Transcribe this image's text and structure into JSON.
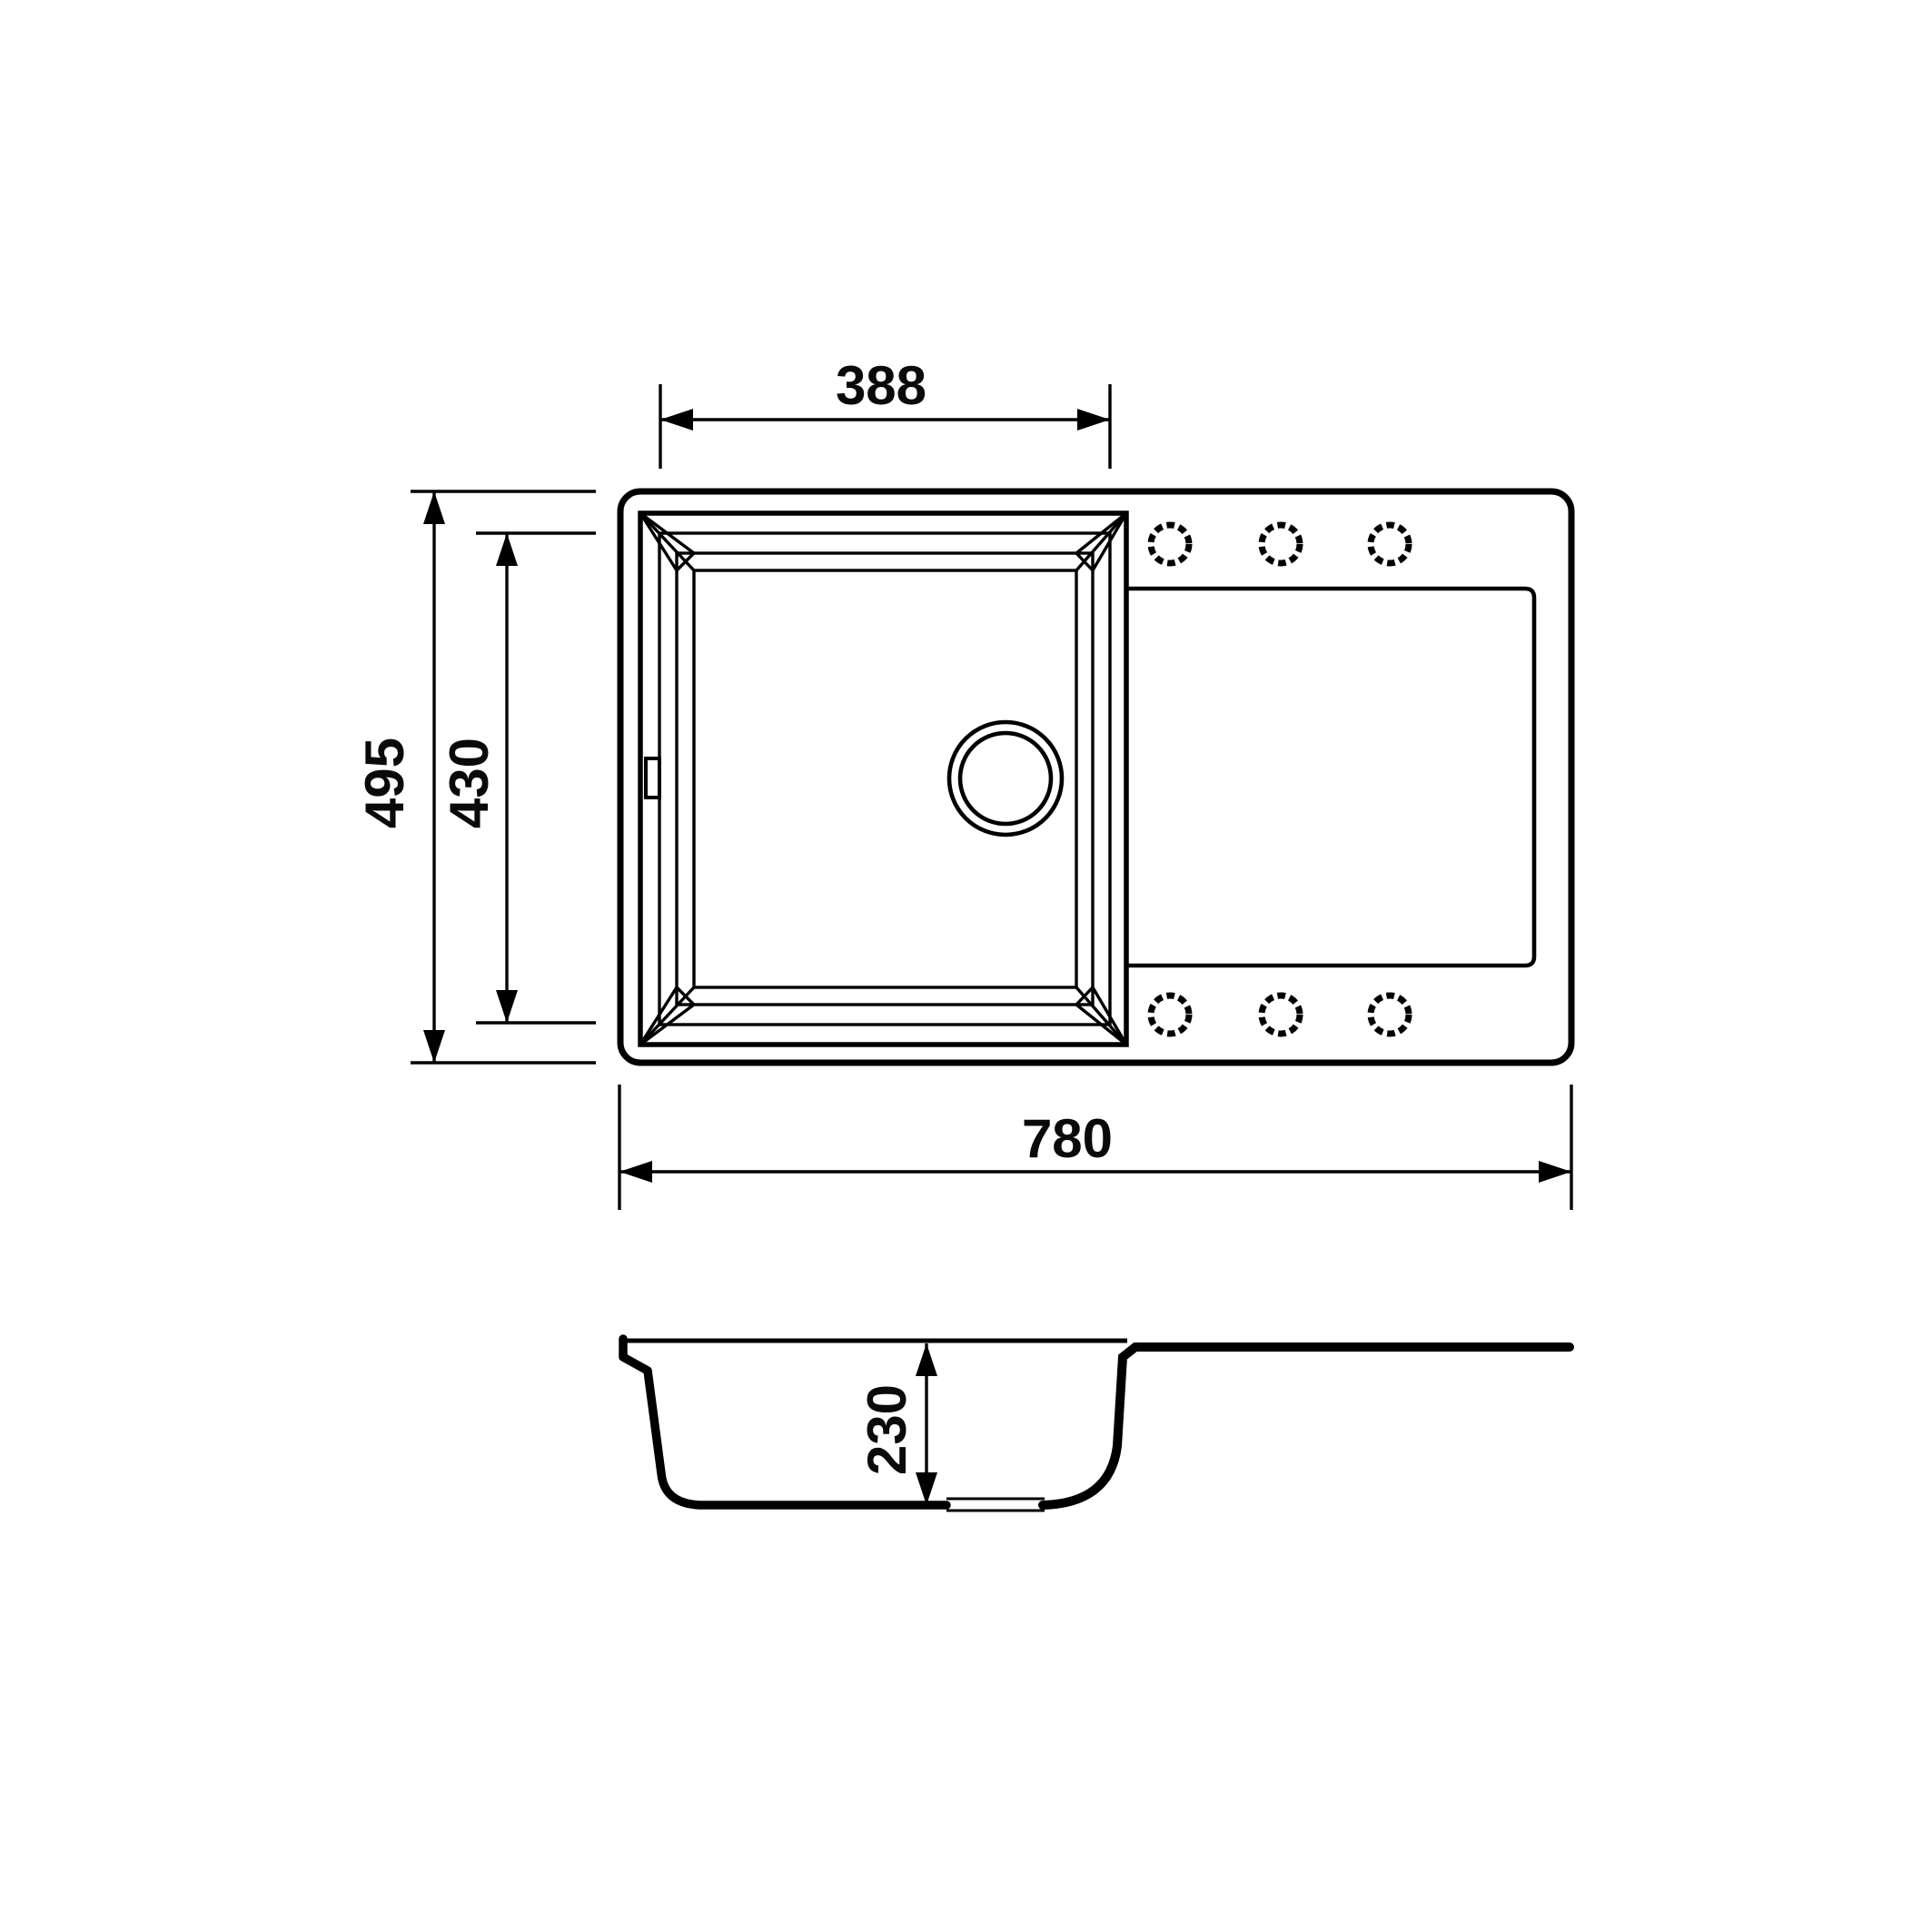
{
  "drawing": {
    "type": "technical-drawing",
    "subject": "kitchen sink with single bowl and drainboard, top view and cross-section view",
    "units": "mm",
    "background_color": "#ffffff",
    "line_color": "#000000",
    "dimensions": {
      "bowl_opening_width": "388",
      "overall_depth": "495",
      "bowl_opening_depth": "430",
      "overall_width": "780",
      "bowl_depth": "230"
    },
    "features": {
      "faucet_hole_count": 6,
      "faucet_holes_style": "dashed circles",
      "drain_style": "two concentric circles",
      "overflow_marker": "small rectangle on left bowl wall",
      "views": [
        "top-view",
        "section-view"
      ]
    }
  }
}
